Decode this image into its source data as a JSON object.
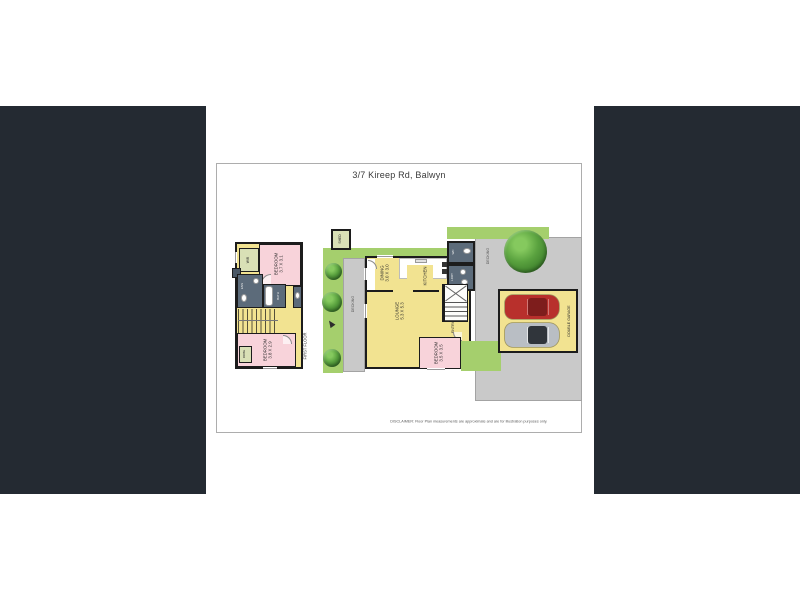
{
  "page": {
    "title": "3/7 Kireep Rd, Balwyn",
    "disclaimer": "DISCLAIMER: Floor Plan measurements are approximate and are for illustration purposes only."
  },
  "first_floor": {
    "floor_label": "FIRST FLOOR",
    "wir": "WIR",
    "bedroom1_name": "BEDROOM",
    "bedroom1_dims": "3.7 X 3.1",
    "ens": "ENS",
    "bath": "BATH",
    "wc": "WC",
    "bedroom2_name": "BEDROOM",
    "bedroom2_dims": "3.8 X 2.9",
    "robe": "ROBE"
  },
  "ground_floor": {
    "shed": "SHED",
    "decking_left": "DECKING",
    "decking_right": "DECKING",
    "dining_name": "DINING",
    "dining_dims": "3.0 X 3.0",
    "kitchen": "KITCHEN",
    "lounge_name": "LOUNGE",
    "lounge_dims": "5.3 X 5.3",
    "entry": "ENTRY",
    "wc": "WC",
    "laundry": "LDRY",
    "bedroom3_name": "BEDROOM",
    "bedroom3_dims": "3.5 X 3.5",
    "garage": "DOUBLE GARAGE"
  },
  "icons": {
    "trees": "tree-icon",
    "north": "north-arrow-icon",
    "cars": [
      "red-car-icon",
      "silver-car-icon"
    ]
  },
  "colors": {
    "side_panels": "#242a32",
    "room_yellow": "#f2e391",
    "room_pink": "#f8d3da",
    "room_green": "#d9e0b6",
    "wet_area_dark": "#5c6b7a",
    "grass": "#a5cf6d",
    "decking_gray": "#c9c9c9",
    "wall": "#1c1c1c",
    "car_red": "#b8302c",
    "car_silver": "#b9bec4"
  }
}
